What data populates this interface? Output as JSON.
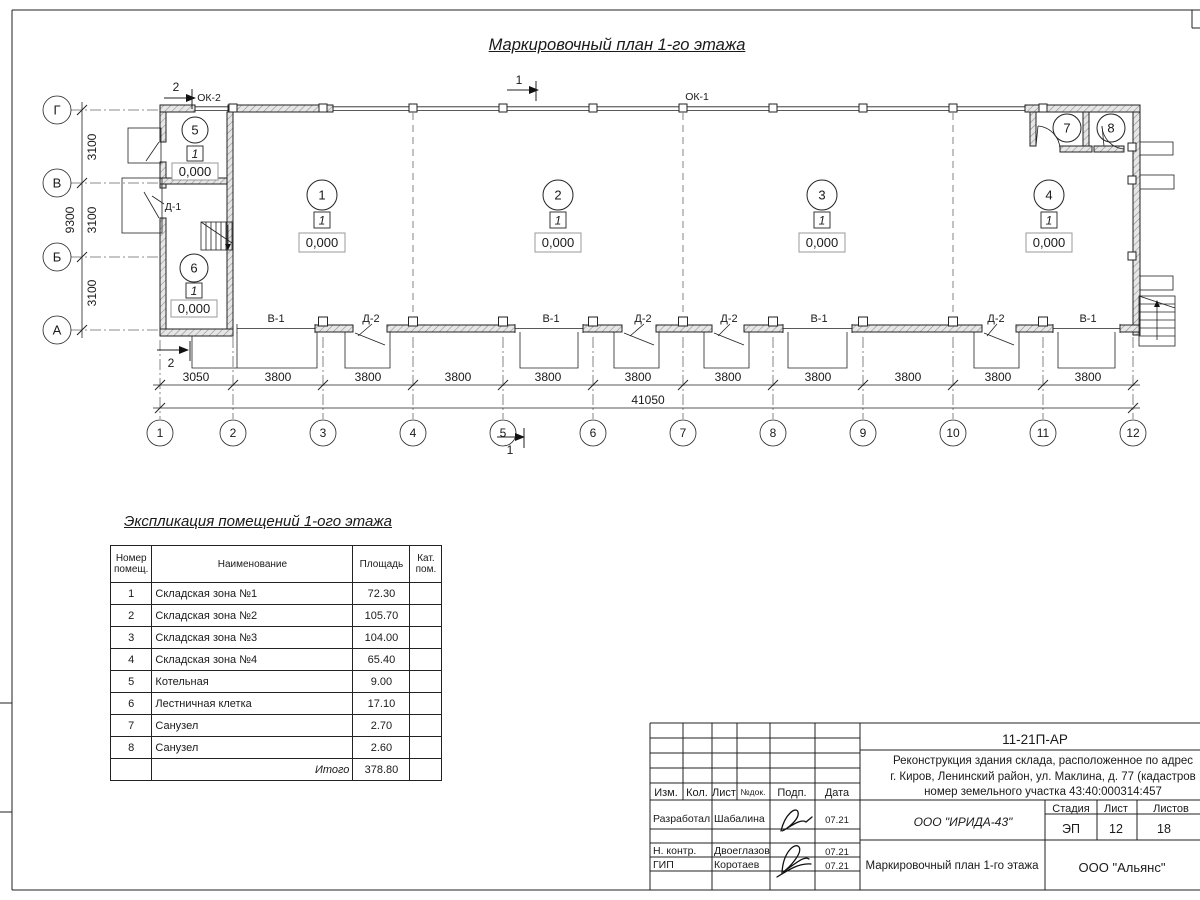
{
  "page": {
    "title": "Маркировочный план 1-го этажа"
  },
  "plan": {
    "axis_letters": [
      "Г",
      "В",
      "Б",
      "А"
    ],
    "axis_numbers": [
      "1",
      "2",
      "3",
      "4",
      "5",
      "6",
      "7",
      "8",
      "9",
      "10",
      "11",
      "12"
    ],
    "v_dims": [
      "3100",
      "3100",
      "3100"
    ],
    "v_total": "9300",
    "h_dims": [
      "3050",
      "3800",
      "3800",
      "3800",
      "3800",
      "3800",
      "3800",
      "3800",
      "3800",
      "3800",
      "3800"
    ],
    "h_total": "41050",
    "sections": {
      "s1": "1",
      "s2": "2"
    },
    "openings": {
      "ok1": "ОК-1",
      "ok2": "ОК-2",
      "d1": "Д-1"
    },
    "bottom_labels": [
      "В-1",
      "Д-2",
      "В-1",
      "Д-2",
      "Д-2",
      "В-1",
      "Д-2",
      "В-1"
    ],
    "rooms": [
      {
        "num": "1",
        "cat": "1",
        "elev": "0,000"
      },
      {
        "num": "2",
        "cat": "1",
        "elev": "0,000"
      },
      {
        "num": "3",
        "cat": "1",
        "elev": "0,000"
      },
      {
        "num": "4",
        "cat": "1",
        "elev": "0,000"
      },
      {
        "num": "5",
        "cat": "1",
        "elev": "0,000"
      },
      {
        "num": "6",
        "cat": "1",
        "elev": "0,000"
      },
      {
        "num": "7"
      },
      {
        "num": "8"
      }
    ]
  },
  "explication": {
    "title": "Экспликация помещений 1-ого этажа",
    "headers": {
      "num": "Номер помещ.",
      "name": "Наименование",
      "area": "Площадь",
      "cat": "Кат. пом."
    },
    "rows": [
      {
        "num": "1",
        "name": "Складская зона №1",
        "area": "72.30"
      },
      {
        "num": "2",
        "name": "Складская зона №2",
        "area": "105.70"
      },
      {
        "num": "3",
        "name": "Складская зона №3",
        "area": "104.00"
      },
      {
        "num": "4",
        "name": "Складская зона №4",
        "area": "65.40"
      },
      {
        "num": "5",
        "name": "Котельная",
        "area": "9.00"
      },
      {
        "num": "6",
        "name": "Лестничная клетка",
        "area": "17.10"
      },
      {
        "num": "7",
        "name": "Санузел",
        "area": "2.70"
      },
      {
        "num": "8",
        "name": "Санузел",
        "area": "2.60"
      }
    ],
    "total_label": "Итого",
    "total_value": "378.80"
  },
  "titleblock": {
    "doc_number": "11-21П-АР",
    "project_lines": [
      "Реконструкция здания склада, расположенное по адрес",
      "г. Киров, Ленинский район, ул. Маклина, д. 77 (кадастров",
      "номер земельного участка 43:40:000314:457"
    ],
    "columns": {
      "izm": "Изм.",
      "kol": "Кол.",
      "list": "Лист",
      "ndok": "№док.",
      "podp": "Подп.",
      "data": "Дата"
    },
    "signers": [
      {
        "role": "Разработал",
        "name": "Шабалина",
        "date": "07.21"
      },
      {
        "role": "Н. контр.",
        "name": "Двоеглазов",
        "date": "07.21"
      },
      {
        "role": "ГИП",
        "name": "Коротаев",
        "date": "07.21"
      }
    ],
    "company": "ООО \"ИРИДА-43\"",
    "stage_label": "Стадия",
    "sheet_label": "Лист",
    "sheets_label": "Листов",
    "stage": "ЭП",
    "sheet_number": "12",
    "sheet_count": "18",
    "drawing_title": "Маркировочный план 1-го этажа",
    "org": "ООО \"Альянс\""
  }
}
